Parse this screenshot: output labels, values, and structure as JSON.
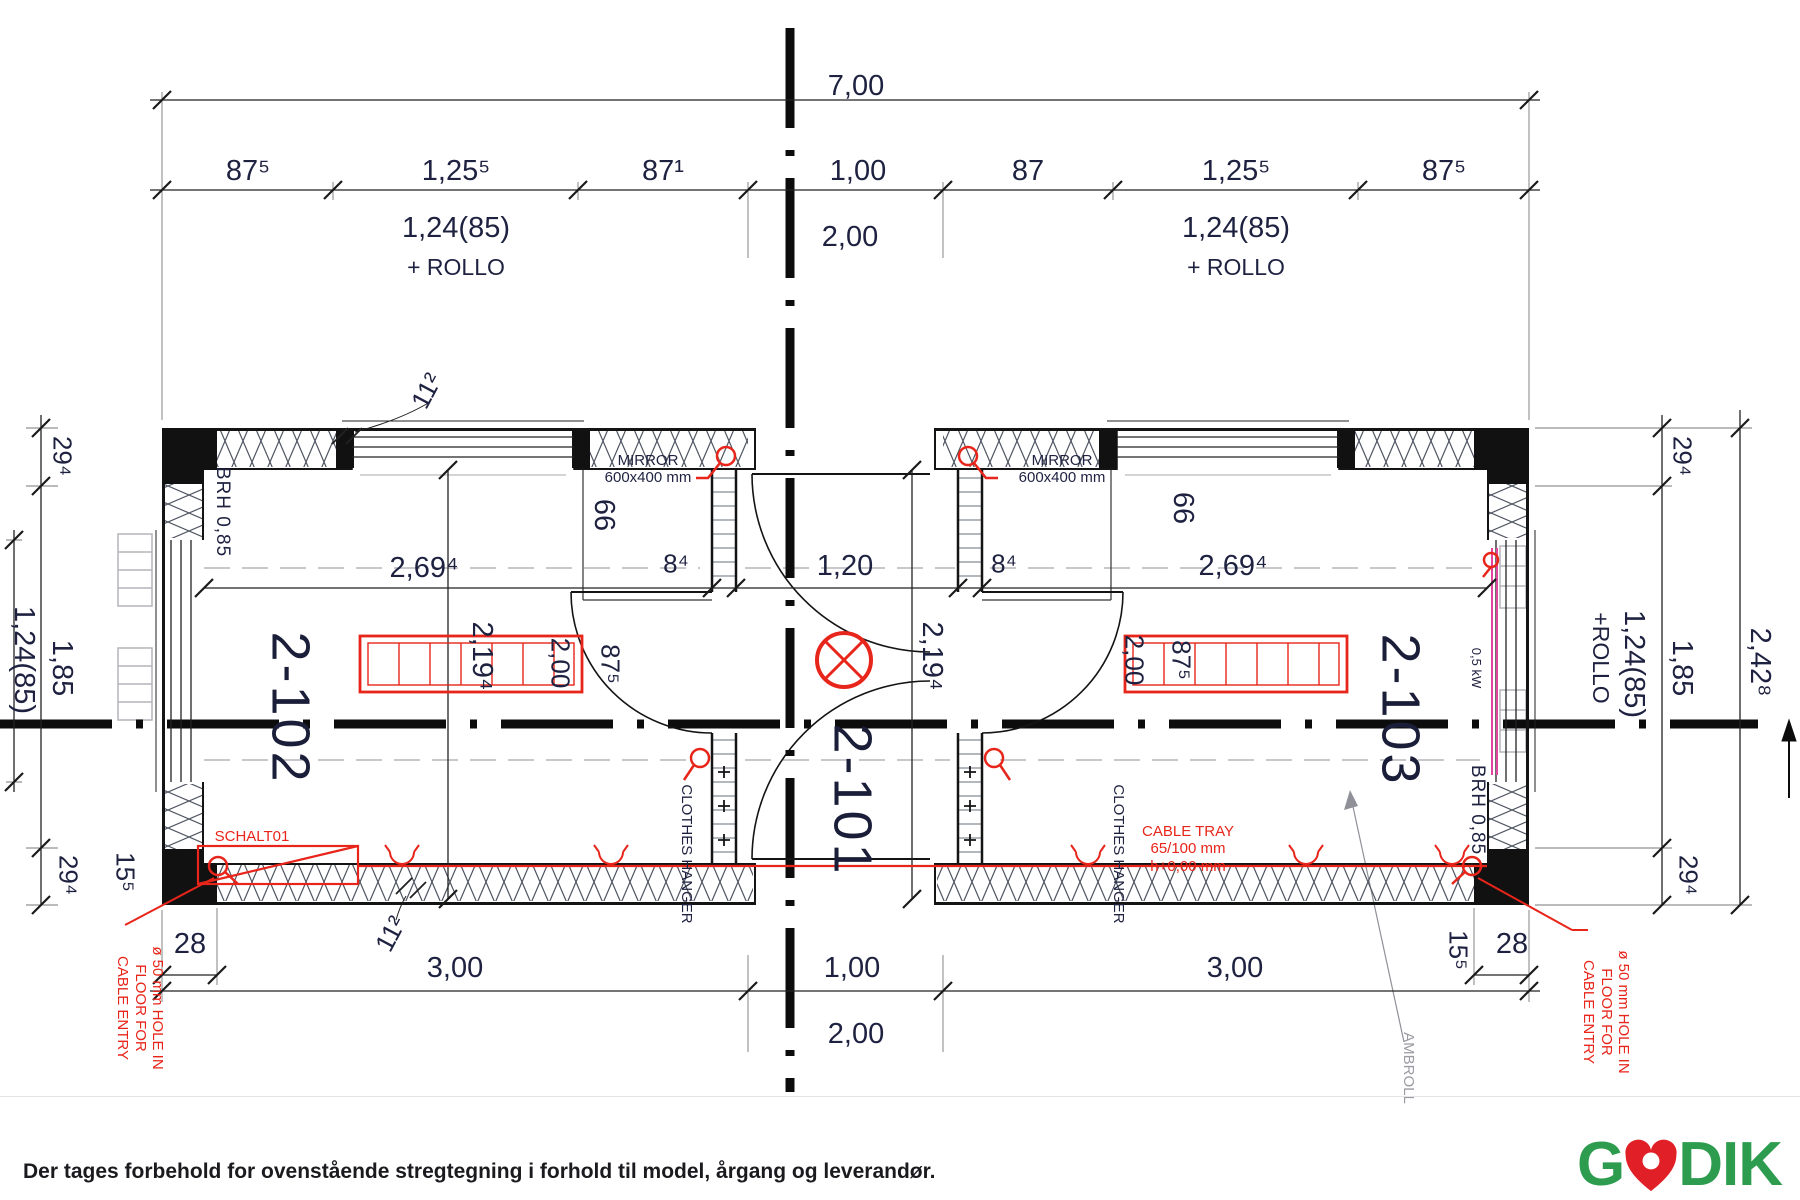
{
  "rooms": {
    "left": "2-102",
    "center": "2-101",
    "right": "2-103"
  },
  "dims": {
    "overall_width": "7,00",
    "top_chain": [
      "87⁵",
      "1,25⁵",
      "87¹",
      "1,00",
      "87",
      "1,25⁵",
      "87⁵"
    ],
    "top_window_left": "1,24(85)",
    "top_window_left_rollo": "+ ROLLO",
    "top_window_right": "1,24(85)",
    "top_window_right_rollo": "+ ROLLO",
    "top_center": "2,00",
    "bottom_left": "3,00",
    "bottom_center": "1,00",
    "bottom_center2": "2,00",
    "bottom_right": "3,00",
    "corner_left": "28",
    "corner_right": "28",
    "post_left": "15⁵",
    "post_right": "15⁵",
    "joint_top": "11²",
    "joint_bottom": "11²",
    "left_chain": [
      "29⁴",
      "1,85",
      "29⁴"
    ],
    "left_window": "1,24(85)",
    "right_chain": [
      "29⁴",
      "1,85",
      "29⁴"
    ],
    "right_overall": "2,42⁸",
    "right_window": "1,24(85)",
    "right_window_rollo": "+ROLLO",
    "room_left_width": "2,69⁴",
    "corridor_width": "1,20",
    "room_right_width": "2,69⁴",
    "partition_left": "8⁴",
    "partition_right": "8⁴",
    "depth_left": "2,19⁴",
    "depth_center": "2,19⁴",
    "radiator_left_length": "2,00",
    "radiator_left_height": "87⁵",
    "radiator_right_length": "2,00",
    "radiator_right_height": "87⁵",
    "closet_left": "66",
    "closet_right": "66"
  },
  "annotations": {
    "mirror_line1": "MIRROR",
    "mirror_line2": "600x400 mm",
    "brh": "BRH 0,85",
    "hanger": "CLOTHES HANGER",
    "roller": "AMBROLL",
    "panel": "SCHALT01",
    "tray_line1": "CABLE TRAY",
    "tray_line2": "65/100 mm",
    "tray_line3": "h+0,00 mm",
    "heater": "0,5 kW",
    "hole_line1": "ø 50 mm HOLE IN",
    "hole_line2": "FLOOR FOR",
    "hole_line3": "CABLE ENTRY"
  },
  "footer": {
    "disclaimer": "Der tages forbehold for ovenstående stregtegning i forhold til model, årgang og leverandør.",
    "brand_g": "G",
    "brand_dik": "DIK"
  },
  "colors": {
    "red": "#e8251a",
    "green": "#2e9c4f",
    "magenta": "#e0459f",
    "ink": "#1e2240"
  }
}
